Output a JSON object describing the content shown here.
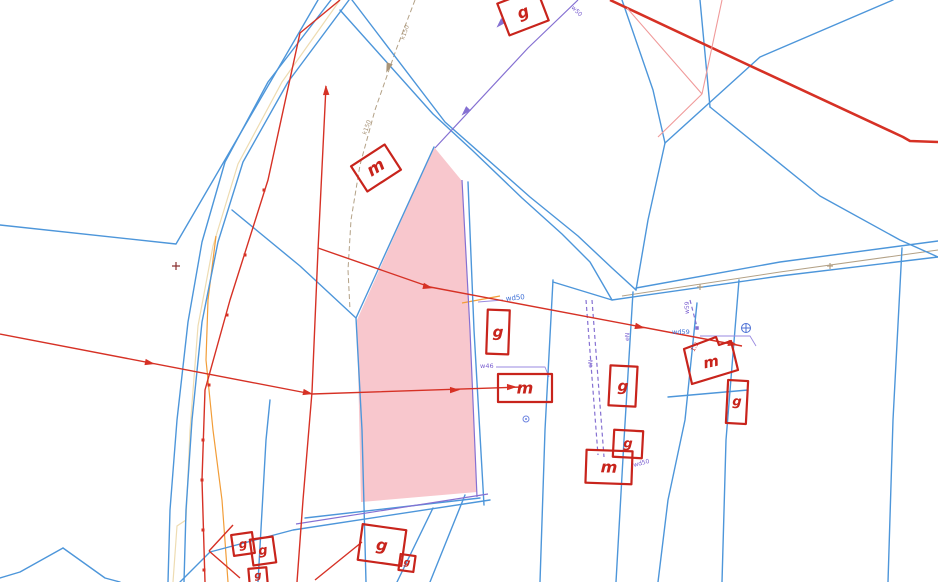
{
  "map": {
    "colors": {
      "blue": "#4d96da",
      "purple": "#8570d2",
      "lpurple": "#9a8ae0",
      "red": "#d63125",
      "darkRed": "#c8241c",
      "lightRed": "#f09a9a",
      "orange": "#f29d38",
      "cream": "#eedcb2",
      "tan": "#b3a186",
      "pink": "#f8c7cd",
      "labelBlue": "#3d6fd6",
      "labelPurple": "#7a5fd0",
      "labelTan": "#a89478",
      "labelRed": "#cc2222",
      "darkPlus": "#8a3030",
      "symBlue": "#4b6fd4",
      "dotBlue": "#6f86e0"
    },
    "selected_parcel": {
      "fill": "#f8c7cd"
    },
    "buildings": [
      {
        "label": "m",
        "x": 376,
        "y": 168,
        "w": 40,
        "h": 30,
        "rot": -33,
        "fs": 17
      },
      {
        "label": "g",
        "x": 523,
        "y": 12,
        "w": 42,
        "h": 34,
        "rot": -21,
        "fs": 16
      },
      {
        "label": "g",
        "x": 498,
        "y": 332,
        "w": 22,
        "h": 44,
        "rot": 2,
        "fs": 15
      },
      {
        "label": "m",
        "x": 525,
        "y": 388,
        "w": 54,
        "h": 28,
        "rot": 0,
        "fs": 16
      },
      {
        "label": "g",
        "x": 623,
        "y": 386,
        "w": 27,
        "h": 40,
        "rot": 3,
        "fs": 15
      },
      {
        "label": "g",
        "x": 628,
        "y": 444,
        "w": 29,
        "h": 27,
        "rot": 3,
        "fs": 13
      },
      {
        "label": "m",
        "x": 609,
        "y": 467,
        "w": 46,
        "h": 33,
        "rot": 2,
        "fs": 16
      },
      {
        "label": "m",
        "x": 711,
        "y": 362,
        "poly": "684,349 716,337 719,345 731,341 738,370 692,384",
        "rot": -12,
        "fs": 15
      },
      {
        "label": "g",
        "x": 737,
        "y": 402,
        "w": 20,
        "h": 43,
        "rot": 3,
        "fs": 13
      },
      {
        "label": "g",
        "x": 243,
        "y": 544,
        "w": 21,
        "h": 21,
        "rot": -8,
        "fs": 12
      },
      {
        "label": "g",
        "x": 263,
        "y": 551,
        "w": 23,
        "h": 26,
        "rot": -8,
        "fs": 13
      },
      {
        "label": "g",
        "x": 382,
        "y": 545,
        "w": 44,
        "h": 36,
        "rot": 8,
        "fs": 16
      },
      {
        "label": "g",
        "x": 407,
        "y": 563,
        "w": 15,
        "h": 16,
        "rot": 8,
        "fs": 9
      },
      {
        "label": "g",
        "x": 258,
        "y": 576,
        "w": 18,
        "h": 16,
        "rot": -5,
        "fs": 10
      }
    ],
    "labels": [
      {
        "text": "wd50",
        "x": 506,
        "y": 301,
        "rot": -6,
        "c": "labelBlue",
        "fs": 7
      },
      {
        "text": "w46",
        "x": 480,
        "y": 368,
        "rot": 0,
        "c": "labelPurple",
        "fs": 6.5
      },
      {
        "text": "wd59",
        "x": 672,
        "y": 334,
        "rot": 0,
        "c": "labelBlue",
        "fs": 6.5
      },
      {
        "text": "w59",
        "x": 689,
        "y": 314,
        "rot": -90,
        "c": "labelPurple",
        "fs": 6
      },
      {
        "text": "eN",
        "x": 592,
        "y": 368,
        "rot": -85,
        "c": "labelPurple",
        "fs": 6
      },
      {
        "text": "eN",
        "x": 629,
        "y": 341,
        "rot": -87,
        "c": "labelPurple",
        "fs": 6
      },
      {
        "text": "wd50",
        "x": 634,
        "y": 467,
        "rot": -15,
        "c": "labelPurple",
        "fs": 6
      },
      {
        "text": "k150",
        "x": 404,
        "y": 40,
        "rot": -70,
        "c": "labelTan",
        "fs": 6
      },
      {
        "text": "k150",
        "x": 366,
        "y": 135,
        "rot": -70,
        "c": "labelTan",
        "fs": 6
      },
      {
        "text": "w50",
        "x": 571,
        "y": 8,
        "rot": 45,
        "c": "labelPurple",
        "fs": 6
      },
      {
        "text": "1.9",
        "x": 694,
        "y": 352,
        "rot": -60,
        "c": "labelRed",
        "fs": 6
      }
    ],
    "symbols": [
      {
        "t": "a",
        "x": 150,
        "y": 363,
        "r": 11,
        "c": "red"
      },
      {
        "t": "a",
        "x": 308,
        "y": 393,
        "r": 11,
        "c": "red"
      },
      {
        "t": "a",
        "x": 455,
        "y": 390,
        "r": -1,
        "c": "red"
      },
      {
        "t": "a",
        "x": 512,
        "y": 387,
        "r": -1,
        "c": "red"
      },
      {
        "t": "a",
        "x": 428,
        "y": 287,
        "r": 13,
        "c": "red"
      },
      {
        "t": "a",
        "x": 640,
        "y": 327,
        "r": 13,
        "c": "red"
      },
      {
        "t": "a",
        "x": 733,
        "y": 344,
        "r": 13,
        "c": "red"
      },
      {
        "t": "a",
        "x": 326,
        "y": 90,
        "r": -92,
        "c": "red"
      },
      {
        "t": "a",
        "x": 500,
        "y": 24,
        "r": 134,
        "c": "purple"
      },
      {
        "t": "a",
        "x": 465,
        "y": 112,
        "r": 134,
        "c": "purple"
      },
      {
        "t": "a",
        "x": 388,
        "y": 68,
        "r": 110,
        "c": "labelTan"
      },
      {
        "t": "sq",
        "x": 264,
        "y": 190,
        "s": 3,
        "c": "red"
      },
      {
        "t": "sq",
        "x": 245,
        "y": 255,
        "s": 3,
        "c": "red"
      },
      {
        "t": "sq",
        "x": 227,
        "y": 315,
        "s": 3,
        "c": "red"
      },
      {
        "t": "sq",
        "x": 209,
        "y": 385,
        "s": 3,
        "c": "red"
      },
      {
        "t": "sq",
        "x": 203,
        "y": 440,
        "s": 3,
        "c": "red"
      },
      {
        "t": "sq",
        "x": 202,
        "y": 480,
        "s": 3,
        "c": "red"
      },
      {
        "t": "sq",
        "x": 203,
        "y": 530,
        "s": 3,
        "c": "red"
      },
      {
        "t": "sq",
        "x": 204,
        "y": 570,
        "s": 3,
        "c": "red"
      },
      {
        "t": "sq",
        "x": 697,
        "y": 328,
        "s": 3.5,
        "c": "purple"
      },
      {
        "t": "plus",
        "x": 176,
        "y": 266,
        "s": 4,
        "c": "darkPlus"
      },
      {
        "t": "plus",
        "x": 700,
        "y": 287,
        "s": 3,
        "c": "tan"
      },
      {
        "t": "plus",
        "x": 830,
        "y": 266,
        "s": 3,
        "c": "tan"
      },
      {
        "t": "cp",
        "x": 746,
        "y": 328,
        "s": 4.5,
        "c": "symBlue"
      },
      {
        "t": "cd",
        "x": 526,
        "y": 419,
        "s": 3,
        "c": "dotBlue"
      }
    ]
  }
}
